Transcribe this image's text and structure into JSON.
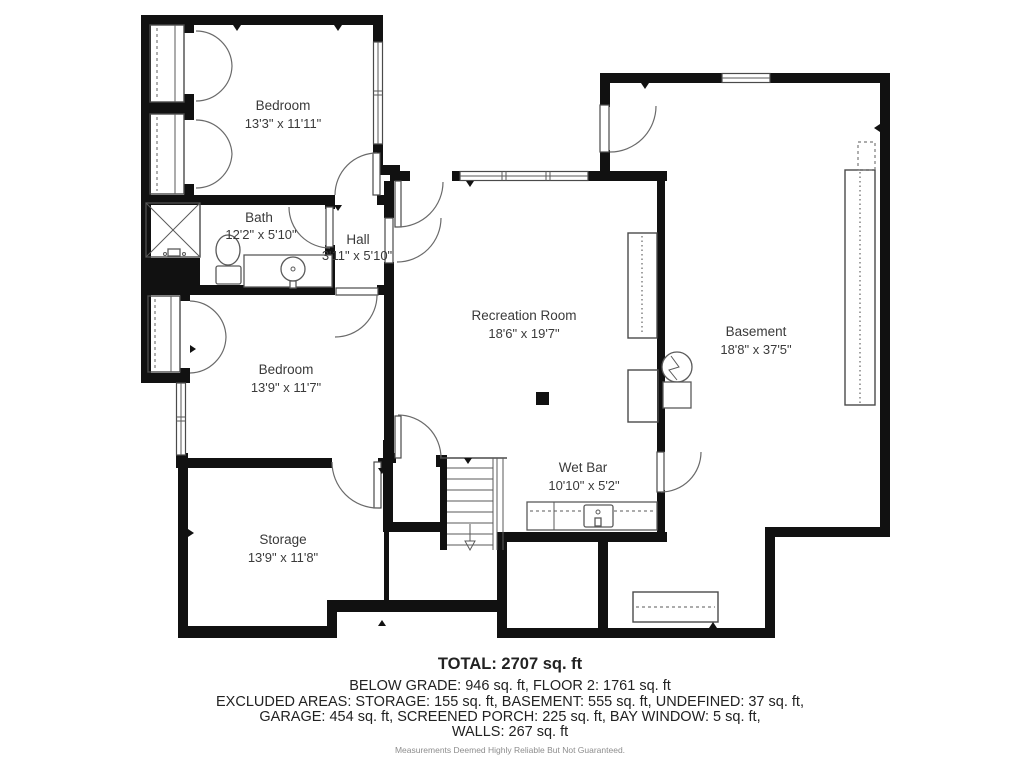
{
  "plan": {
    "rooms": [
      {
        "name": "Bedroom",
        "dims": "13'3\" x 11'11\""
      },
      {
        "name": "Bath",
        "dims": "12'2\" x 5'10\""
      },
      {
        "name": "Hall",
        "dims": "3'11\" x 5'10\""
      },
      {
        "name": "Bedroom",
        "dims": "13'9\" x 11'7\""
      },
      {
        "name": "Storage",
        "dims": "13'9\" x 11'8\""
      },
      {
        "name": "Recreation Room",
        "dims": "18'6\" x 19'7\""
      },
      {
        "name": "Wet Bar",
        "dims": "10'10\" x 5'2\""
      },
      {
        "name": "Basement",
        "dims": "18'8\" x 37'5\""
      }
    ],
    "summary": {
      "total": "TOTAL: 2707 sq. ft",
      "line2": "BELOW GRADE: 946 sq. ft, FLOOR 2: 1761 sq. ft",
      "line3": "EXCLUDED AREAS: STORAGE: 155 sq. ft, BASEMENT: 555 sq. ft, UNDEFINED: 37 sq. ft,",
      "line4": "GARAGE: 454 sq. ft, SCREENED PORCH: 225 sq. ft, BAY WINDOW: 5 sq. ft,",
      "line5": "WALLS: 267 sq. ft",
      "disclaimer": "Measurements Deemed Highly Reliable But Not Guaranteed."
    },
    "colors": {
      "wall": "#111111",
      "line": "#4a4a4a",
      "text": "#3a3a3a",
      "disclaimer": "#8d8d8d"
    }
  }
}
